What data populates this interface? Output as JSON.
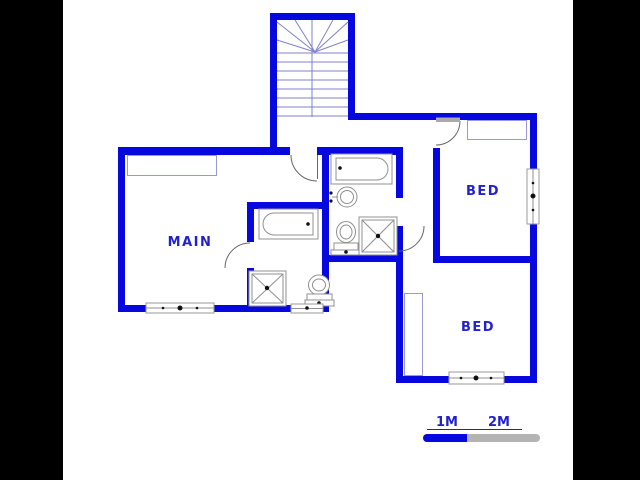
{
  "floor_plan": {
    "type": "residential-floor-plan",
    "rooms": [
      {
        "name": "main-bedroom",
        "label": "MAIN"
      },
      {
        "name": "bedroom-1",
        "label": "BED"
      },
      {
        "name": "bedroom-2",
        "label": "BED"
      }
    ],
    "fixtures": [
      "staircase",
      "bathtub-family-bathroom",
      "washbasin",
      "toilet-family-bathroom",
      "shower-family-bathroom",
      "bathtub-ensuite",
      "shower-ensuite",
      "toilet-ensuite",
      "window-main-bedroom",
      "window-ensuite",
      "window-bedroom-1",
      "window-bedroom-2",
      "cupboard-main-bedroom",
      "cupboard-bedroom-1",
      "wardrobe-bedroom-2"
    ],
    "scale_bar": {
      "labels": [
        "1M",
        "2M"
      ]
    },
    "colors": {
      "wall_blue": "#0707e0",
      "label_blue": "#2222cc",
      "scale_gray": "#b4b4b4",
      "letterbox_black": "#000000",
      "fixture_gray": "#909090",
      "stair_line_blue": "#8080cc",
      "door_arc_gray": "#666666",
      "cupboard_line_blue": "#9898d8",
      "background": "#ffffff"
    }
  }
}
